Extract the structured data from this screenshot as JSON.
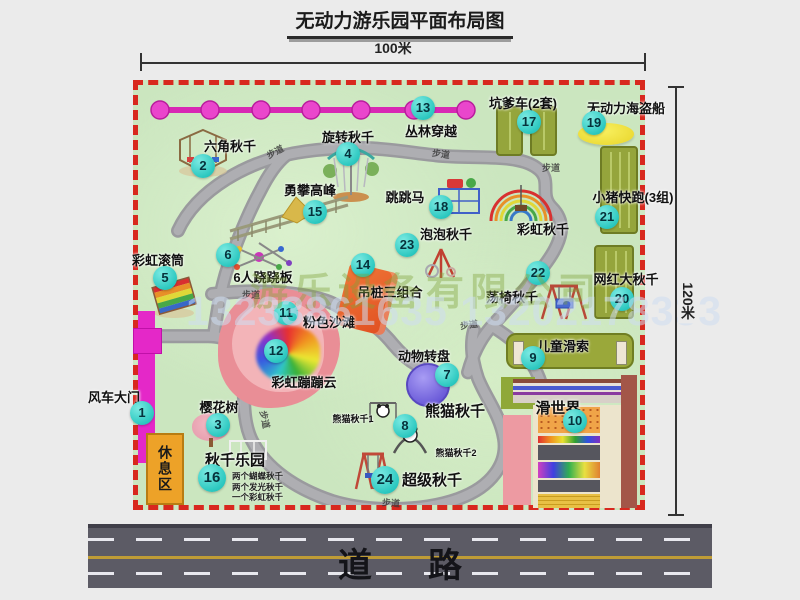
{
  "title": "无动力游乐园平面布局图",
  "dimensions": {
    "top": "100米",
    "right": "120米"
  },
  "road": {
    "label": "道路"
  },
  "watermark": {
    "company": "游乐设备有限公司",
    "phones": "13233861635 13202178333"
  },
  "trail": "步道",
  "rest_area": "休息区",
  "rainbow_swing_label": "彩虹秋千",
  "panda_sub1": "熊猫秋千1",
  "panda_sub2": "熊猫秋千2",
  "swing_park_notes": {
    "line1": "两个蝴蝶秋千",
    "line2": "两个发光秋千",
    "line3": "一个彩虹秋千"
  },
  "pois": {
    "p1": {
      "num": "1",
      "label": "风车大门"
    },
    "p2": {
      "num": "2",
      "label": "六角秋千"
    },
    "p3": {
      "num": "3",
      "label": "樱花树"
    },
    "p4": {
      "num": "4",
      "label": "旋转秋千"
    },
    "p5": {
      "num": "5",
      "label": "彩虹滚筒"
    },
    "p6": {
      "num": "6",
      "label": "6人跷跷板"
    },
    "p7": {
      "num": "7",
      "label": "动物转盘"
    },
    "p8": {
      "num": "8",
      "label": "熊猫秋千"
    },
    "p9": {
      "num": "9",
      "label": "儿童滑索"
    },
    "p10": {
      "num": "10",
      "label": "滑世界"
    },
    "p11": {
      "num": "11",
      "label": "粉色沙滩"
    },
    "p12": {
      "num": "12",
      "label": "彩虹蹦蹦云"
    },
    "p13": {
      "num": "13",
      "label": "丛林穿越"
    },
    "p14": {
      "num": "14",
      "label": "吊桩三组合"
    },
    "p15": {
      "num": "15",
      "label": "勇攀高峰"
    },
    "p16": {
      "num": "16",
      "label": "秋千乐园"
    },
    "p17": {
      "num": "17",
      "label": "坑爹车(2套)"
    },
    "p18": {
      "num": "18",
      "label": "跳跳马"
    },
    "p19": {
      "num": "19",
      "label": "无动力海盗船"
    },
    "p20": {
      "num": "20",
      "label": "网红大秋千"
    },
    "p21": {
      "num": "21",
      "label": "小猪快跑(3组)"
    },
    "p22": {
      "num": "22",
      "label": "荡椅秋千"
    },
    "p23": {
      "num": "23",
      "label": "泡泡秋千"
    },
    "p24": {
      "num": "24",
      "label": "超级秋千"
    }
  },
  "colors": {
    "map_green": "#cbe6bf",
    "border_red": "#d8281e",
    "marker_teal": "#2cc8c0",
    "jungle_magenta": "#e438c4",
    "road_gray": "#5c5b65"
  }
}
